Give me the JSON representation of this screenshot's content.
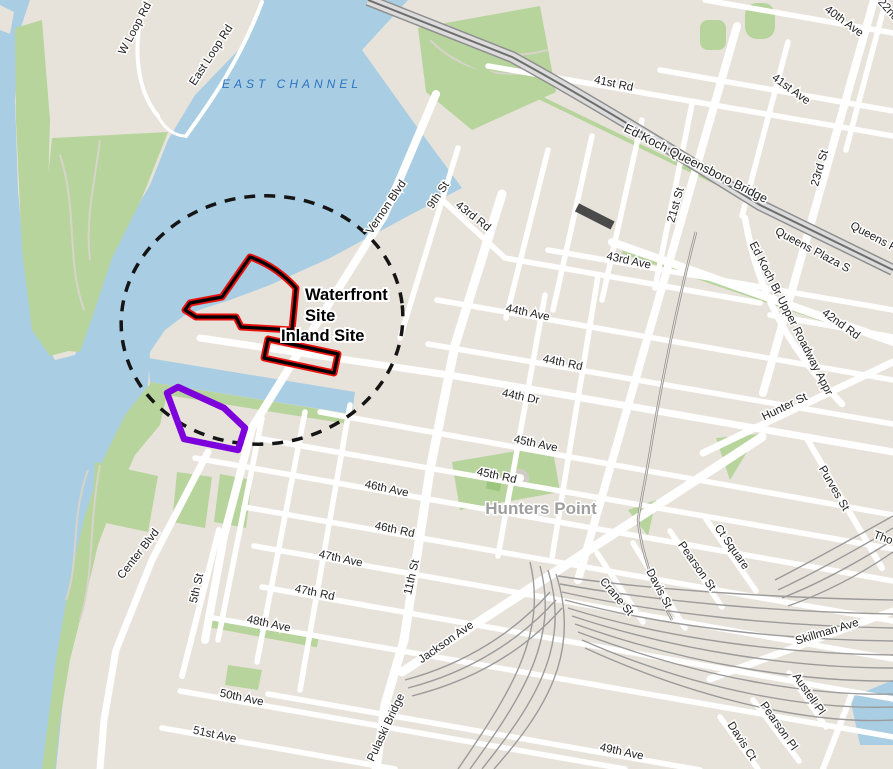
{
  "map": {
    "region_labels": {
      "water_channel": "EAST CHANNEL",
      "neighborhood": "Hunters Point"
    },
    "sites": {
      "waterfront_site_line1": "Waterfront",
      "waterfront_site_line2": "Site",
      "inland_site": "Inland Site"
    },
    "colors": {
      "water": "#a9cde3",
      "land": "#e8e3da",
      "park": "#b7d49c",
      "road": "#ffffff",
      "railway": "#8f8f8f",
      "bridge_casing": "#8f8f8f",
      "bridge_deck": "#dcdcdc",
      "site_outline_red": "#e8120e",
      "site_outline_black": "#000000",
      "parcel_outline_purple": "#7d00dc",
      "study_boundary_dash": "#151515",
      "street_label": "#1f1f1f",
      "water_label": "#2e74c0",
      "neighborhood_label": "#9e9e9e"
    }
  },
  "labels": [
    {
      "text": "W Loop Rd"
    },
    {
      "text": "East Loop Rd"
    },
    {
      "text": "40th Ave"
    },
    {
      "text": "22nd"
    },
    {
      "text": "41st Ave"
    },
    {
      "text": "41st Rd"
    },
    {
      "text": "Ed Koch Queensboro Bridge"
    },
    {
      "text": "23rd St"
    },
    {
      "text": "21st St"
    },
    {
      "text": "Queens Plaza S"
    },
    {
      "text": "Queens Pla"
    },
    {
      "text": "Ed Koch Br Upper Roadway Appr"
    },
    {
      "text": "42nd Rd"
    },
    {
      "text": "43rd Ave"
    },
    {
      "text": "43rd Rd"
    },
    {
      "text": "Vernon Blvd"
    },
    {
      "text": "9th St"
    },
    {
      "text": "44th Ave"
    },
    {
      "text": "44th Rd"
    },
    {
      "text": "44th Dr"
    },
    {
      "text": "Hunter St"
    },
    {
      "text": "45th Ave"
    },
    {
      "text": "45th Rd"
    },
    {
      "text": "46th Ave"
    },
    {
      "text": "46th Rd"
    },
    {
      "text": "47th Ave"
    },
    {
      "text": "47th Rd"
    },
    {
      "text": "48th Ave"
    },
    {
      "text": "49th Ave"
    },
    {
      "text": "50th Ave"
    },
    {
      "text": "51st Ave"
    },
    {
      "text": "Center Blvd"
    },
    {
      "text": "5th St"
    },
    {
      "text": "11th St"
    },
    {
      "text": "Jackson Ave"
    },
    {
      "text": "Pulaski Bridge"
    },
    {
      "text": "Skillman Ave"
    },
    {
      "text": "Austell Pl"
    },
    {
      "text": "Pearson Pl"
    },
    {
      "text": "Davis Ct"
    },
    {
      "text": "Crane St"
    },
    {
      "text": "Davis St"
    },
    {
      "text": "Pearson St"
    },
    {
      "text": "Ct Square"
    },
    {
      "text": "Purves St"
    },
    {
      "text": "Tho"
    }
  ]
}
